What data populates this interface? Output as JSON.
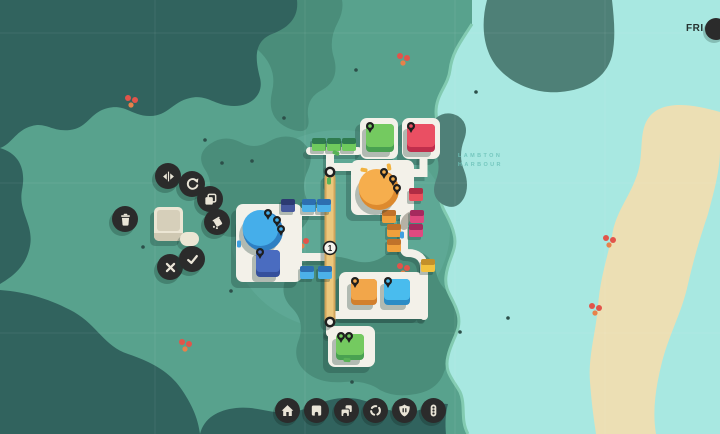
{
  "hud": {
    "day": "FRI"
  },
  "colors": {
    "land": "#58a28d",
    "land_light": "#5ea895",
    "land_dark": "#4a8d7a",
    "cliff": "#4e8077",
    "water_dark": "#31635e",
    "water_light": "#a8e8e1",
    "sand": "#ecdfb4",
    "road": "#f3f1e9",
    "road_gray": "#b5b1a6",
    "bridge": "#ecc77c",
    "bridge_edge": "#d2a55b",
    "ui_circle": "#2b2b2b",
    "ui_icon": "#eae5d7",
    "shadow": "rgba(27,61,53,0.30)"
  },
  "map": {
    "labels": [
      {
        "text": "LAMBTON",
        "x": 458,
        "y": 157
      },
      {
        "text": "HARBOUR",
        "x": 458,
        "y": 166
      }
    ],
    "bridge_badge": {
      "value": "1",
      "x": 330,
      "y": 248
    },
    "road_rings": [
      {
        "x": 330,
        "y": 172
      },
      {
        "x": 330,
        "y": 322
      }
    ],
    "plazas": [
      {
        "x": 360,
        "y": 118,
        "w": 38,
        "h": 41
      },
      {
        "x": 402,
        "y": 118,
        "w": 38,
        "h": 41
      },
      {
        "x": 351,
        "y": 160,
        "w": 63,
        "h": 55
      },
      {
        "x": 236,
        "y": 204,
        "w": 66,
        "h": 78
      },
      {
        "x": 339,
        "y": 272,
        "w": 84,
        "h": 45
      },
      {
        "x": 328,
        "y": 326,
        "w": 47,
        "h": 41
      }
    ],
    "destinations": [
      {
        "shape": "circle",
        "cx": 263,
        "cy": 231,
        "r": 20,
        "light": "#45aeea",
        "dark": "#2e7fc2",
        "pins": [
          [
            268,
            213
          ],
          [
            277,
            220
          ],
          [
            281,
            229
          ]
        ]
      },
      {
        "shape": "circle",
        "cx": 379,
        "cy": 190,
        "r": 20,
        "light": "#f6ae4d",
        "dark": "#dd8a2e",
        "pins": [
          [
            384,
            172
          ],
          [
            393,
            179
          ],
          [
            397,
            188
          ]
        ]
      },
      {
        "shape": "rect",
        "x": 366,
        "y": 124,
        "w": 28,
        "h": 28,
        "light": "#74ca60",
        "dark": "#49a151",
        "pins": [
          [
            370,
            126
          ]
        ]
      },
      {
        "shape": "rect",
        "x": 407,
        "y": 124,
        "w": 28,
        "h": 28,
        "light": "#ea4f63",
        "dark": "#c02e4c",
        "pins": [
          [
            411,
            126
          ]
        ]
      },
      {
        "shape": "rect",
        "x": 351,
        "y": 279,
        "w": 26,
        "h": 26,
        "light": "#f2a64a",
        "dark": "#d2802e",
        "pins": [
          [
            355,
            281
          ]
        ]
      },
      {
        "shape": "rect",
        "x": 384,
        "y": 279,
        "w": 26,
        "h": 26,
        "light": "#49bcee",
        "dark": "#2b8cc6",
        "pins": [
          [
            388,
            281
          ]
        ]
      },
      {
        "shape": "rect",
        "x": 256,
        "y": 250,
        "w": 24,
        "h": 27,
        "light": "#4a6cc0",
        "dark": "#35509c",
        "pins": [
          [
            260,
            252
          ]
        ]
      },
      {
        "shape": "rect",
        "x": 336,
        "y": 334,
        "w": 28,
        "h": 26,
        "light": "#74ca60",
        "dark": "#49a151",
        "pins": [
          [
            341,
            336
          ],
          [
            349,
            336
          ]
        ]
      }
    ],
    "houses": [
      {
        "x": 312,
        "y": 138,
        "body": "#6fca5d",
        "roof": "#2f7b4f"
      },
      {
        "x": 327,
        "y": 138,
        "body": "#6fca5d",
        "roof": "#2f7b4f"
      },
      {
        "x": 342,
        "y": 138,
        "body": "#6fca5d",
        "roof": "#2f7b4f"
      },
      {
        "x": 281,
        "y": 199,
        "body": "#46589e",
        "roof": "#2c3a72"
      },
      {
        "x": 302,
        "y": 199,
        "body": "#4cb1e8",
        "roof": "#2d6fb0"
      },
      {
        "x": 317,
        "y": 199,
        "body": "#4cb1e8",
        "roof": "#2d6fb0"
      },
      {
        "x": 300,
        "y": 266,
        "body": "#4cb1e8",
        "roof": "#2d6fb0"
      },
      {
        "x": 318,
        "y": 266,
        "body": "#4cb1e8",
        "roof": "#2d6fb0"
      },
      {
        "x": 409,
        "y": 188,
        "body": "#e84f5c",
        "roof": "#b02c44"
      },
      {
        "x": 410,
        "y": 210,
        "body": "#e04980",
        "roof": "#a62a5e"
      },
      {
        "x": 409,
        "y": 224,
        "body": "#e04980",
        "roof": "#a62a5e"
      },
      {
        "x": 382,
        "y": 210,
        "body": "#f0a03c",
        "roof": "#c0722a"
      },
      {
        "x": 387,
        "y": 224,
        "body": "#f0a03c",
        "roof": "#c0722a"
      },
      {
        "x": 387,
        "y": 239,
        "body": "#f0a03c",
        "roof": "#c0722a"
      },
      {
        "x": 421,
        "y": 259,
        "body": "#f2c23e",
        "roof": "#c3902a"
      }
    ],
    "cars": [
      {
        "x": 336,
        "y": 153,
        "angle": 25,
        "color": "#59b356"
      },
      {
        "x": 329,
        "y": 181,
        "angle": 90,
        "color": "#59b356"
      },
      {
        "x": 239,
        "y": 244,
        "angle": 90,
        "color": "#3f9fe0"
      },
      {
        "x": 402,
        "y": 235,
        "angle": 90,
        "color": "#3f9fe0"
      },
      {
        "x": 364,
        "y": 170,
        "angle": 10,
        "color": "#f2b23f"
      },
      {
        "x": 389,
        "y": 167,
        "angle": 80,
        "color": "#f2b23f"
      },
      {
        "x": 347,
        "y": 360,
        "angle": 5,
        "color": "#59b356"
      }
    ],
    "berry_clusters": [
      {
        "x": 404,
        "y": 59
      },
      {
        "x": 132,
        "y": 101
      },
      {
        "x": 303,
        "y": 242
      },
      {
        "x": 186,
        "y": 345
      },
      {
        "x": 404,
        "y": 269
      },
      {
        "x": 610,
        "y": 241
      },
      {
        "x": 596,
        "y": 309
      }
    ],
    "tree_dots": [
      [
        222,
        163
      ],
      [
        252,
        161
      ],
      [
        143,
        247
      ],
      [
        231,
        291
      ],
      [
        205,
        140
      ],
      [
        356,
        70
      ],
      [
        284,
        118
      ],
      [
        460,
        332
      ],
      [
        508,
        318
      ],
      [
        352,
        382
      ],
      [
        476,
        92
      ]
    ]
  },
  "placement_panel": {
    "buttons": [
      {
        "name": "flip-button",
        "icon": "flip-horizontal-icon",
        "cx": 168,
        "cy": 176
      },
      {
        "name": "rotate-button",
        "icon": "rotate-icon",
        "cx": 192,
        "cy": 184
      },
      {
        "name": "duplicate-button",
        "icon": "duplicate-icon",
        "cx": 210,
        "cy": 199
      },
      {
        "name": "paint-button",
        "icon": "paint-icon",
        "cx": 217,
        "cy": 222
      },
      {
        "name": "delete-button",
        "icon": "trash-icon",
        "cx": 125,
        "cy": 219
      },
      {
        "name": "cancel-button",
        "icon": "cancel-icon",
        "cx": 170,
        "cy": 267
      },
      {
        "name": "confirm-button",
        "icon": "check-icon",
        "cx": 192,
        "cy": 259
      }
    ]
  },
  "toolbar": {
    "buttons": [
      {
        "name": "houses-button",
        "icon": "house-icon",
        "cx": 287,
        "cy": 410
      },
      {
        "name": "destination-button",
        "icon": "building-icon",
        "cx": 316,
        "cy": 410
      },
      {
        "name": "destinations-button",
        "icon": "buildings-icon",
        "cx": 346,
        "cy": 410
      },
      {
        "name": "roundabout-button",
        "icon": "roundabout-icon",
        "cx": 375,
        "cy": 410
      },
      {
        "name": "motorway-button",
        "icon": "shield-icon",
        "cx": 404,
        "cy": 410
      },
      {
        "name": "traffic-light-button",
        "icon": "traffic-light-icon",
        "cx": 433,
        "cy": 410
      }
    ]
  }
}
